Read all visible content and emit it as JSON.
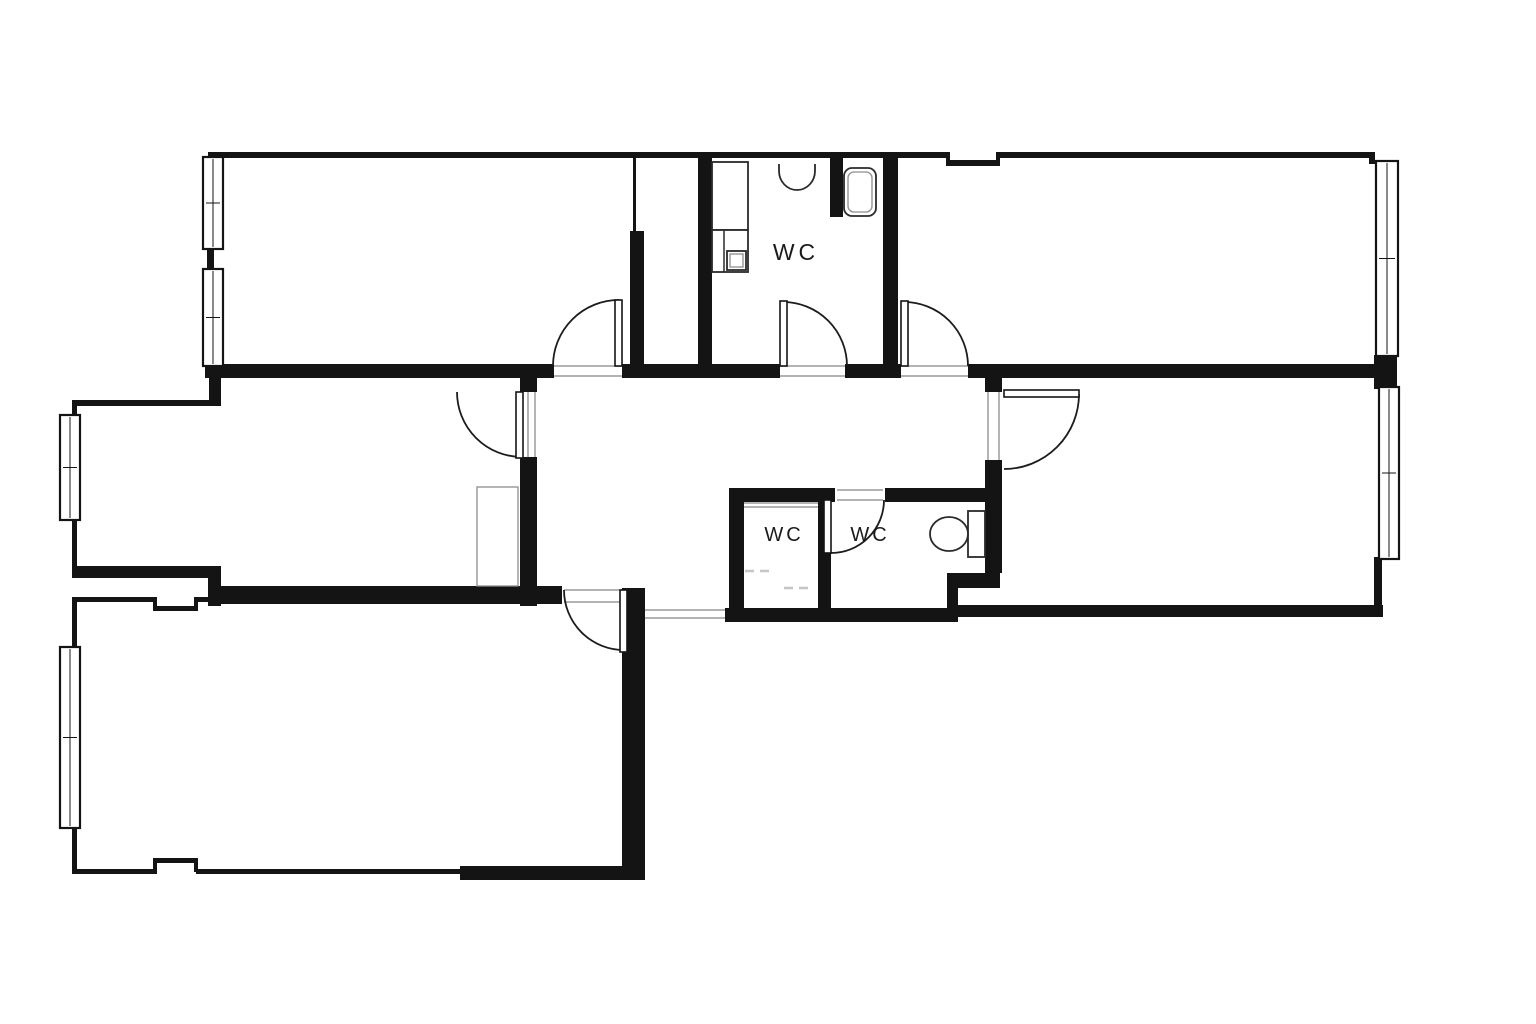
{
  "plan": {
    "canvas": {
      "width": 1536,
      "height": 1024,
      "background": "#ffffff"
    },
    "colors": {
      "wall": "#141414",
      "arc": "#1c1c1c",
      "threshold": "#9a9a9a",
      "fixture": "#2a2a2a",
      "fixture_light": "#8d8d8d",
      "dash": "#c6c6c6",
      "window_fill": "#ffffff",
      "label": "#1b1b1b"
    },
    "labels": [
      {
        "text": "WC",
        "x": 796,
        "y": 260,
        "size": 23,
        "ls": 4
      },
      {
        "text": "WC",
        "x": 784,
        "y": 541,
        "size": 20,
        "ls": 3
      },
      {
        "text": "WC",
        "x": 870,
        "y": 541,
        "size": 20,
        "ls": 3
      }
    ],
    "walls_thick": [
      [
        213,
        364,
        341,
        14
      ],
      [
        622,
        364,
        158,
        14
      ],
      [
        845,
        364,
        56,
        14
      ],
      [
        968,
        364,
        409,
        14
      ],
      [
        520,
        364,
        17,
        28
      ],
      [
        520,
        457,
        17,
        149
      ],
      [
        216,
        586,
        346,
        18
      ],
      [
        622,
        588,
        23,
        292
      ],
      [
        460,
        866,
        185,
        14
      ],
      [
        72,
        566,
        136,
        12
      ],
      [
        208,
        566,
        13,
        40
      ],
      [
        209,
        364,
        12,
        42
      ],
      [
        630,
        231,
        14,
        133
      ],
      [
        698,
        152,
        14,
        212
      ],
      [
        883,
        152,
        15,
        212
      ],
      [
        830,
        152,
        13,
        65
      ],
      [
        729,
        488,
        15,
        134
      ],
      [
        729,
        488,
        106,
        14
      ],
      [
        885,
        488,
        117,
        14
      ],
      [
        818,
        500,
        13,
        108
      ],
      [
        725,
        608,
        233,
        14
      ],
      [
        985,
        364,
        17,
        28
      ],
      [
        985,
        460,
        17,
        113
      ],
      [
        947,
        573,
        53,
        15
      ],
      [
        947,
        588,
        11,
        22
      ],
      [
        1374,
        355,
        23,
        34
      ],
      [
        205,
        360,
        16,
        18
      ]
    ],
    "walls_thin": [
      [
        213,
        152,
        735,
        6
      ],
      [
        946,
        152,
        4,
        14
      ],
      [
        948,
        160,
        50,
        6
      ],
      [
        996,
        152,
        4,
        14
      ],
      [
        998,
        152,
        375,
        6
      ],
      [
        1369,
        152,
        6,
        12
      ],
      [
        208,
        152,
        6,
        10
      ],
      [
        207,
        246,
        7,
        28
      ],
      [
        73,
        400,
        143,
        6
      ],
      [
        72,
        400,
        5,
        19
      ],
      [
        72,
        519,
        5,
        49
      ],
      [
        72,
        597,
        85,
        5
      ],
      [
        153,
        597,
        4,
        14
      ],
      [
        153,
        606,
        45,
        5
      ],
      [
        194,
        597,
        4,
        14
      ],
      [
        196,
        597,
        20,
        5
      ],
      [
        72,
        597,
        5,
        52
      ],
      [
        72,
        826,
        5,
        47
      ],
      [
        72,
        869,
        85,
        5
      ],
      [
        153,
        858,
        45,
        5
      ],
      [
        153,
        858,
        4,
        14
      ],
      [
        194,
        858,
        4,
        14
      ],
      [
        196,
        869,
        264,
        5
      ],
      [
        1374,
        557,
        8,
        56
      ],
      [
        958,
        605,
        425,
        12
      ],
      [
        633,
        158,
        3,
        75
      ]
    ],
    "windows": [
      [
        203,
        157,
        20,
        92
      ],
      [
        203,
        269,
        20,
        97
      ],
      [
        60,
        415,
        20,
        105
      ],
      [
        60,
        647,
        20,
        181
      ],
      [
        1376,
        161,
        22,
        195
      ],
      [
        1379,
        387,
        20,
        172
      ]
    ],
    "thresholds": [
      [
        554,
        366,
        622,
        366
      ],
      [
        554,
        376,
        622,
        376
      ],
      [
        528,
        392,
        528,
        457
      ],
      [
        535,
        392,
        535,
        457
      ],
      [
        780,
        366,
        845,
        366
      ],
      [
        780,
        376,
        845,
        376
      ],
      [
        901,
        366,
        968,
        366
      ],
      [
        901,
        376,
        968,
        376
      ],
      [
        988,
        392,
        988,
        460
      ],
      [
        999,
        392,
        999,
        460
      ],
      [
        564,
        590,
        622,
        590
      ],
      [
        564,
        602,
        622,
        602
      ],
      [
        837,
        490,
        883,
        490
      ],
      [
        837,
        500,
        883,
        500
      ],
      [
        645,
        610,
        725,
        610
      ],
      [
        645,
        618,
        725,
        618
      ],
      [
        744,
        503,
        818,
        503
      ],
      [
        744,
        507,
        818,
        507
      ]
    ],
    "door_leaves": [
      [
        615,
        300,
        7,
        66
      ],
      [
        516,
        392,
        7,
        66
      ],
      [
        780,
        301,
        7,
        65
      ],
      [
        901,
        301,
        7,
        65
      ],
      [
        1004,
        390,
        75,
        7
      ],
      [
        620,
        590,
        7,
        62
      ],
      [
        824,
        500,
        7,
        53
      ]
    ],
    "door_arcs": [
      "M 553 366 A 66 66 0 0 1 619 300",
      "M 522 457 A 65 65 0 0 1 457 392",
      "M 783 302 A 64 64 0 0 1 847 366",
      "M 904 302 A 64 64 0 0 1 968 366",
      "M 1079 394 A 75 75 0 0 1 1004 469",
      "M 564 590 A 60 60 0 0 0 624 650",
      "M 884 500 A 53 53 0 0 1 831 553"
    ],
    "shower_dashes": [
      [
        745,
        571,
        770,
        571
      ],
      [
        784,
        588,
        812,
        588
      ]
    ],
    "fixtures": [
      {
        "kind": "rect",
        "name": "wc-cabinet",
        "x": 712,
        "y": 162,
        "w": 36,
        "h": 68
      },
      {
        "kind": "rect",
        "name": "wc-cabinet",
        "x": 712,
        "y": 230,
        "w": 36,
        "h": 42
      },
      {
        "kind": "line",
        "name": "wc-cabinet-divider",
        "x1": 724,
        "y1": 230,
        "x2": 724,
        "y2": 272
      },
      {
        "kind": "rect",
        "name": "wc-sink-unit",
        "x": 727,
        "y": 251,
        "w": 19,
        "h": 19
      },
      {
        "kind": "rect",
        "name": "wc-sink-unit-inner",
        "x": 730,
        "y": 254,
        "w": 13,
        "h": 13,
        "light": true
      },
      {
        "kind": "path",
        "name": "hand-basin-icon",
        "d": "M 779 164 L 779 171 A 18 19 0 0 0 815 171 L 815 164"
      },
      {
        "kind": "rrect",
        "name": "toilet-icon",
        "x": 844,
        "y": 168,
        "w": 32,
        "h": 48,
        "rx": 8
      },
      {
        "kind": "rrect",
        "name": "toilet-icon-inner",
        "x": 848,
        "y": 172,
        "w": 24,
        "h": 40,
        "rx": 6,
        "light": true
      },
      {
        "kind": "rect",
        "name": "toilet-tank-icon",
        "x": 968,
        "y": 511,
        "w": 17,
        "h": 46
      },
      {
        "kind": "ellipse",
        "name": "toilet-bowl-icon",
        "cx": 949,
        "cy": 534,
        "rx": 19,
        "ry": 17
      },
      {
        "kind": "rect",
        "name": "wardrobe",
        "x": 477,
        "y": 487,
        "w": 41,
        "h": 99,
        "light": true
      }
    ]
  }
}
